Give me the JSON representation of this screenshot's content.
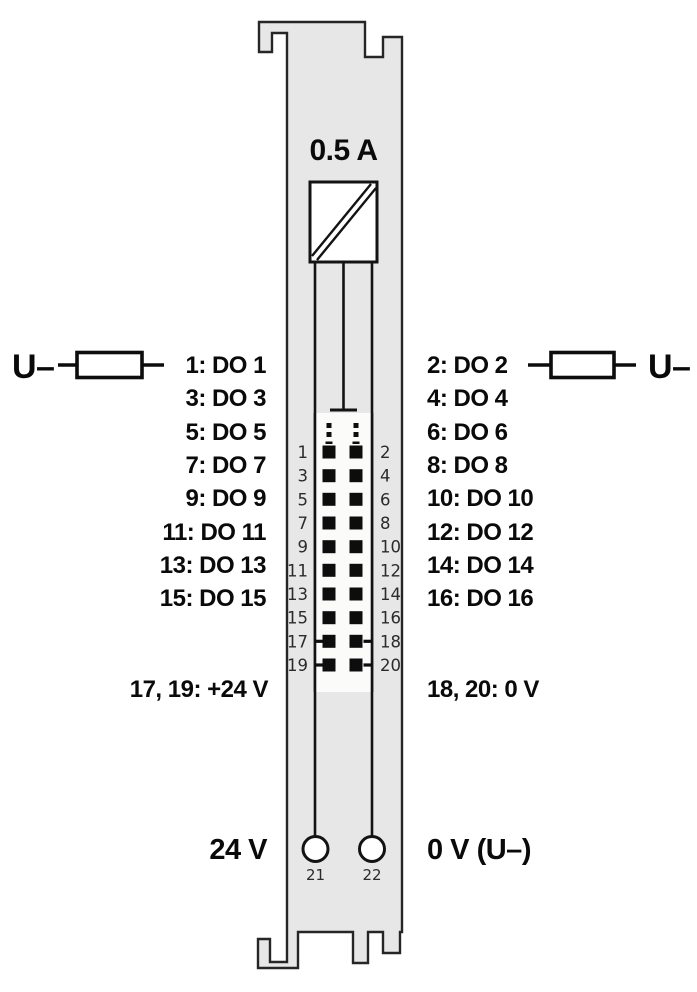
{
  "fuse": {
    "rating": "0.5 A"
  },
  "left": {
    "u_minus": "U–",
    "outputs": [
      "1: DO 1",
      "3: DO 3",
      "5: DO 5",
      "7: DO 7",
      "9: DO 9",
      "11: DO 11",
      "13: DO 13",
      "15: DO 15"
    ],
    "power_label": "17, 19: +24 V",
    "supply_label": "24 V"
  },
  "right": {
    "u_minus": "U–",
    "outputs": [
      "2: DO 2",
      "4: DO 4",
      "6: DO 6",
      "8: DO 8",
      "10: DO 10",
      "12: DO 12",
      "14: DO 14",
      "16: DO 16"
    ],
    "power_label": "18, 20: 0 V",
    "supply_label": "0 V (U–)"
  },
  "connector": {
    "pins_left": [
      "1",
      "3",
      "5",
      "7",
      "9",
      "11",
      "13",
      "15",
      "17",
      "19"
    ],
    "pins_right": [
      "2",
      "4",
      "6",
      "8",
      "10",
      "12",
      "14",
      "16",
      "18",
      "20"
    ]
  },
  "terminals": {
    "left_number": "21",
    "right_number": "22"
  },
  "colors": {
    "body_fill": "#e7e7e7",
    "outline": "#262626",
    "connector_fill": "#fbfbfa",
    "pin_black": "#0d0d0d",
    "text": "#0a0a0a"
  }
}
